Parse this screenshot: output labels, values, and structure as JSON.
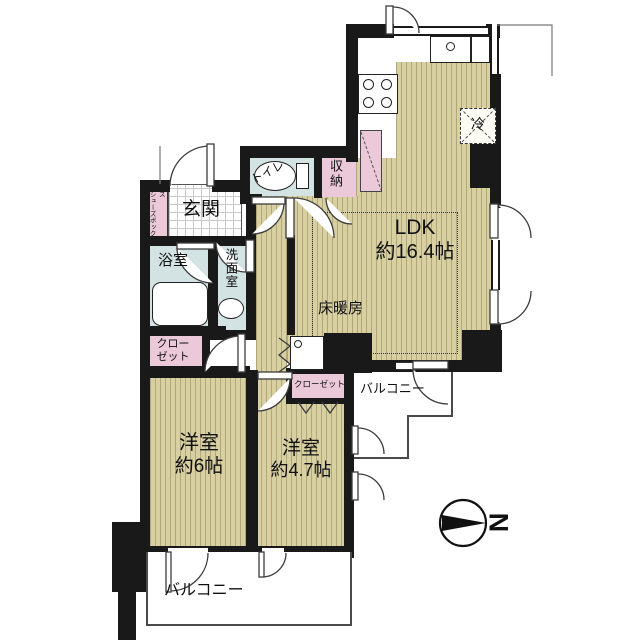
{
  "meta": {
    "type": "floor-plan",
    "units": "帖"
  },
  "colors": {
    "wall": "#191919",
    "wood_floor": "#d9d0a2",
    "wet_area": "#d3e2e3",
    "storage_pink": "#ecc9d8",
    "outline": "#555555"
  },
  "rooms": {
    "ldk": {
      "label": "LDK",
      "size": "約16.4帖"
    },
    "room6": {
      "label": "洋室",
      "size": "約6帖"
    },
    "room47": {
      "label": "洋室",
      "size": "約4.7帖"
    },
    "entrance": {
      "label": "玄関"
    },
    "bath": {
      "label": "浴室"
    },
    "washroom": {
      "label": "洗面室"
    },
    "toilet": {
      "label": "トイレ"
    },
    "storage": {
      "label": "収納"
    },
    "closet_main": {
      "label": "クローゼット"
    },
    "closet_sub": {
      "label": "クローゼット"
    },
    "shoe_box": {
      "label": "シューズボックス"
    },
    "floor_heating": {
      "label": "床暖房"
    },
    "refrigerator": {
      "label": "冷"
    },
    "balcony_bottom": {
      "label": "バルコニー"
    },
    "balcony_right": {
      "label": "バルコニー"
    }
  },
  "compass": {
    "label": "N",
    "direction": "right"
  }
}
